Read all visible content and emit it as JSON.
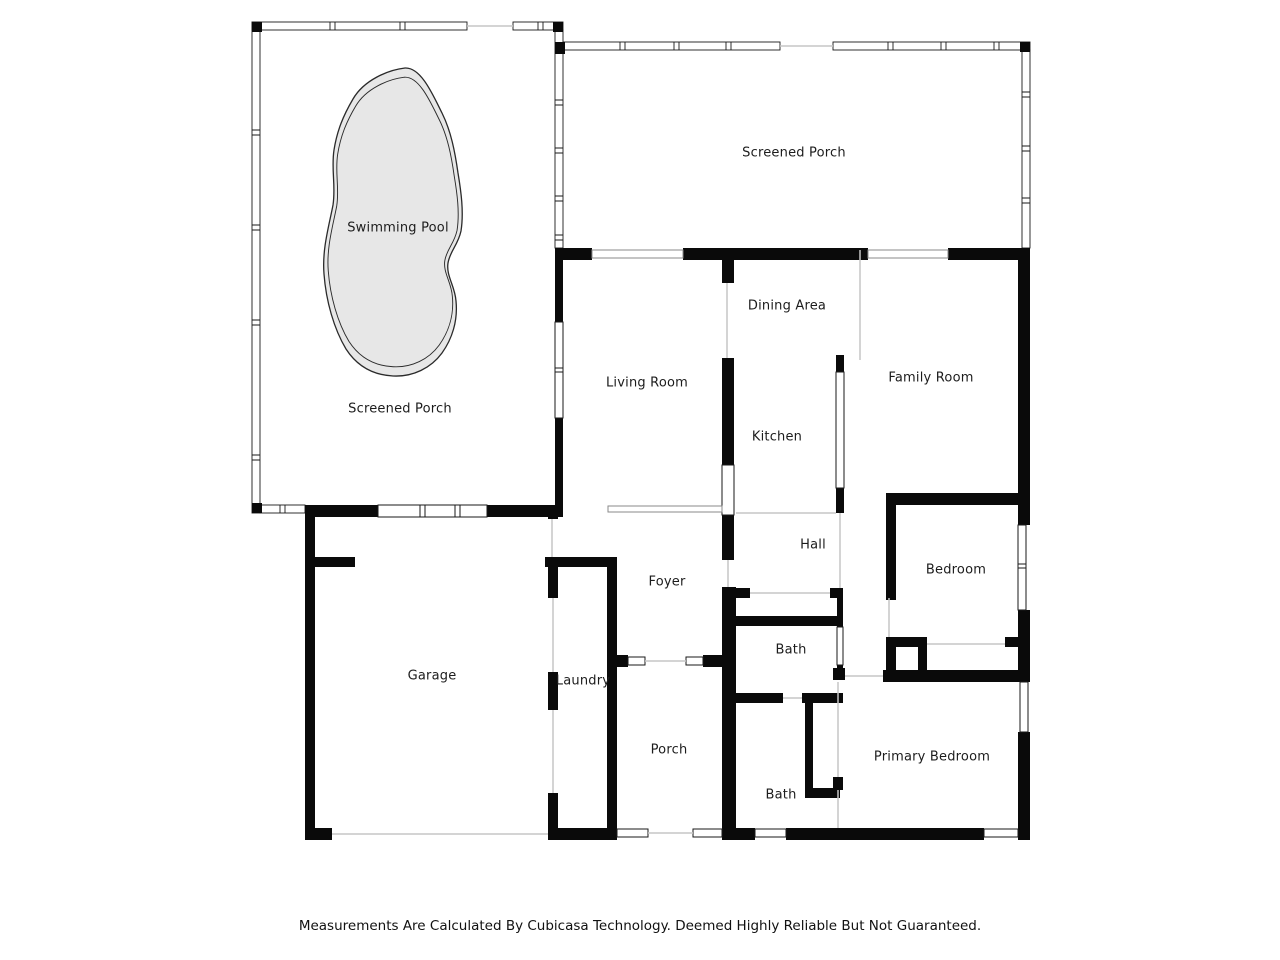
{
  "floor_plan": {
    "rooms": [
      {
        "id": "swimming-pool",
        "label": "Swimming Pool"
      },
      {
        "id": "screened-porch-pool",
        "label": "Screened Porch"
      },
      {
        "id": "screened-porch-top",
        "label": "Screened Porch"
      },
      {
        "id": "living-room",
        "label": "Living Room"
      },
      {
        "id": "dining-area",
        "label": "Dining Area"
      },
      {
        "id": "kitchen",
        "label": "Kitchen"
      },
      {
        "id": "family-room",
        "label": "Family Room"
      },
      {
        "id": "hall",
        "label": "Hall"
      },
      {
        "id": "bedroom",
        "label": "Bedroom"
      },
      {
        "id": "bath-upper",
        "label": "Bath"
      },
      {
        "id": "primary-bedroom",
        "label": "Primary Bedroom"
      },
      {
        "id": "bath-lower",
        "label": "Bath"
      },
      {
        "id": "foyer",
        "label": "Foyer"
      },
      {
        "id": "laundry",
        "label": "Laundry"
      },
      {
        "id": "porch",
        "label": "Porch"
      },
      {
        "id": "garage",
        "label": "Garage"
      }
    ],
    "disclaimer": "Measurements Are Calculated By Cubicasa Technology. Deemed Highly Reliable But Not Guaranteed.",
    "colors": {
      "wall": "#0a0a0a",
      "pool_fill": "#e7e7e7",
      "background": "#ffffff",
      "label_text": "#1c1c1c"
    }
  }
}
